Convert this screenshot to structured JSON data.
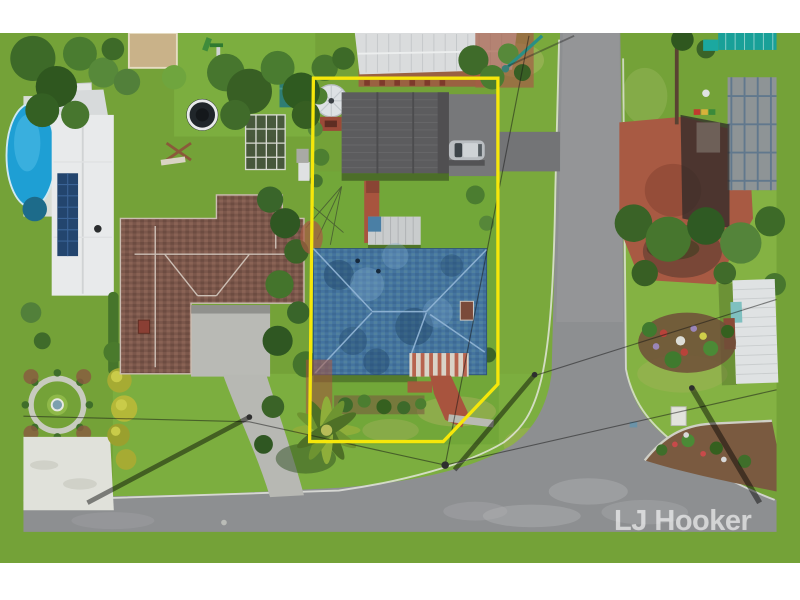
{
  "photo": {
    "kind": "top-down aerial drone photograph",
    "subject": "suburban residential lot highlighted with a yellow boundary outline, blue hip-roof house, detached garage, neighbouring houses, corner road intersection"
  },
  "watermark": {
    "text": "LJ Hooker",
    "color": "#ffffff",
    "opacity": 0.55
  },
  "lot_boundary": {
    "points": "308,81 504,81 504,406 446,467 304,467",
    "color": "#f6e70a",
    "stroke_width": "3.5"
  },
  "palette": {
    "letterbox_border": "#ffffff",
    "lawn_green": "#74a238",
    "bright_lawn": "#84b243",
    "road_grey": "#8d8f91",
    "main_roof_blue": "#44749f",
    "left_roof_brown": "#7b574b",
    "garage_roof_grey": "#5c5c5e",
    "red_paving": "#a8543e",
    "pool_blue": "#1e9fd4",
    "construction_teal": "#19a098"
  }
}
